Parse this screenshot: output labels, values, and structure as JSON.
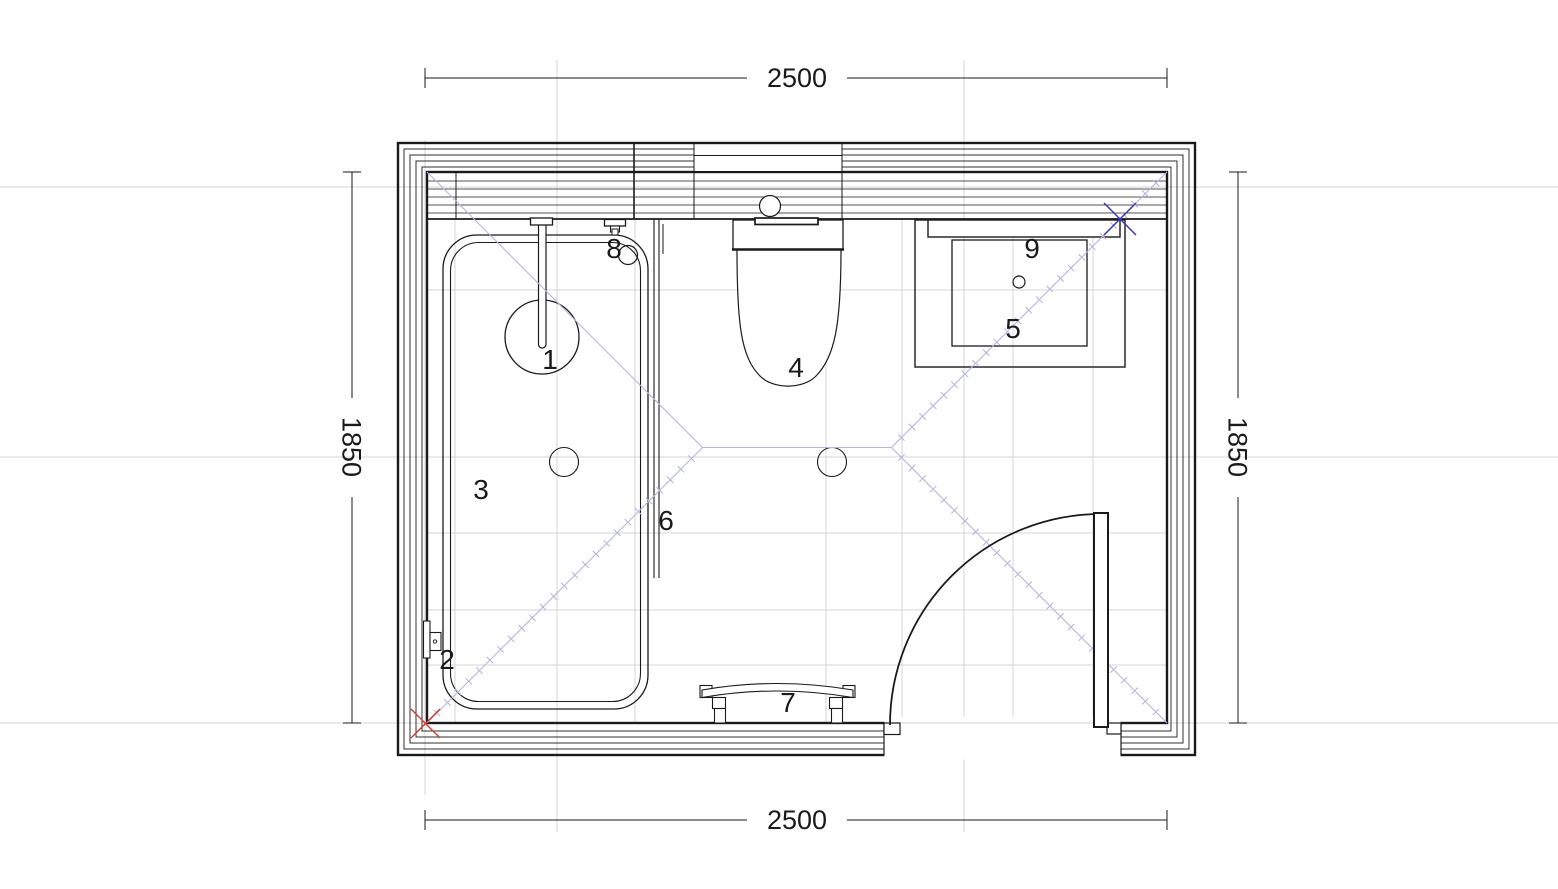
{
  "dimensions": {
    "top": "2500",
    "bottom": "2500",
    "left": "1850",
    "right": "1850"
  },
  "fixture_labels": {
    "item1": "1",
    "item2": "2",
    "item3": "3",
    "item4": "4",
    "item5": "5",
    "item6": "6",
    "item7": "7",
    "item8": "8",
    "item9": "9"
  },
  "colors": {
    "line": "#1a1a1a",
    "grid_line": "#d4d4d4",
    "construction_line": "#b6b6de",
    "marker_red": "#cc3b33",
    "marker_blue": "#3a3ab8",
    "background": "#ffffff"
  }
}
